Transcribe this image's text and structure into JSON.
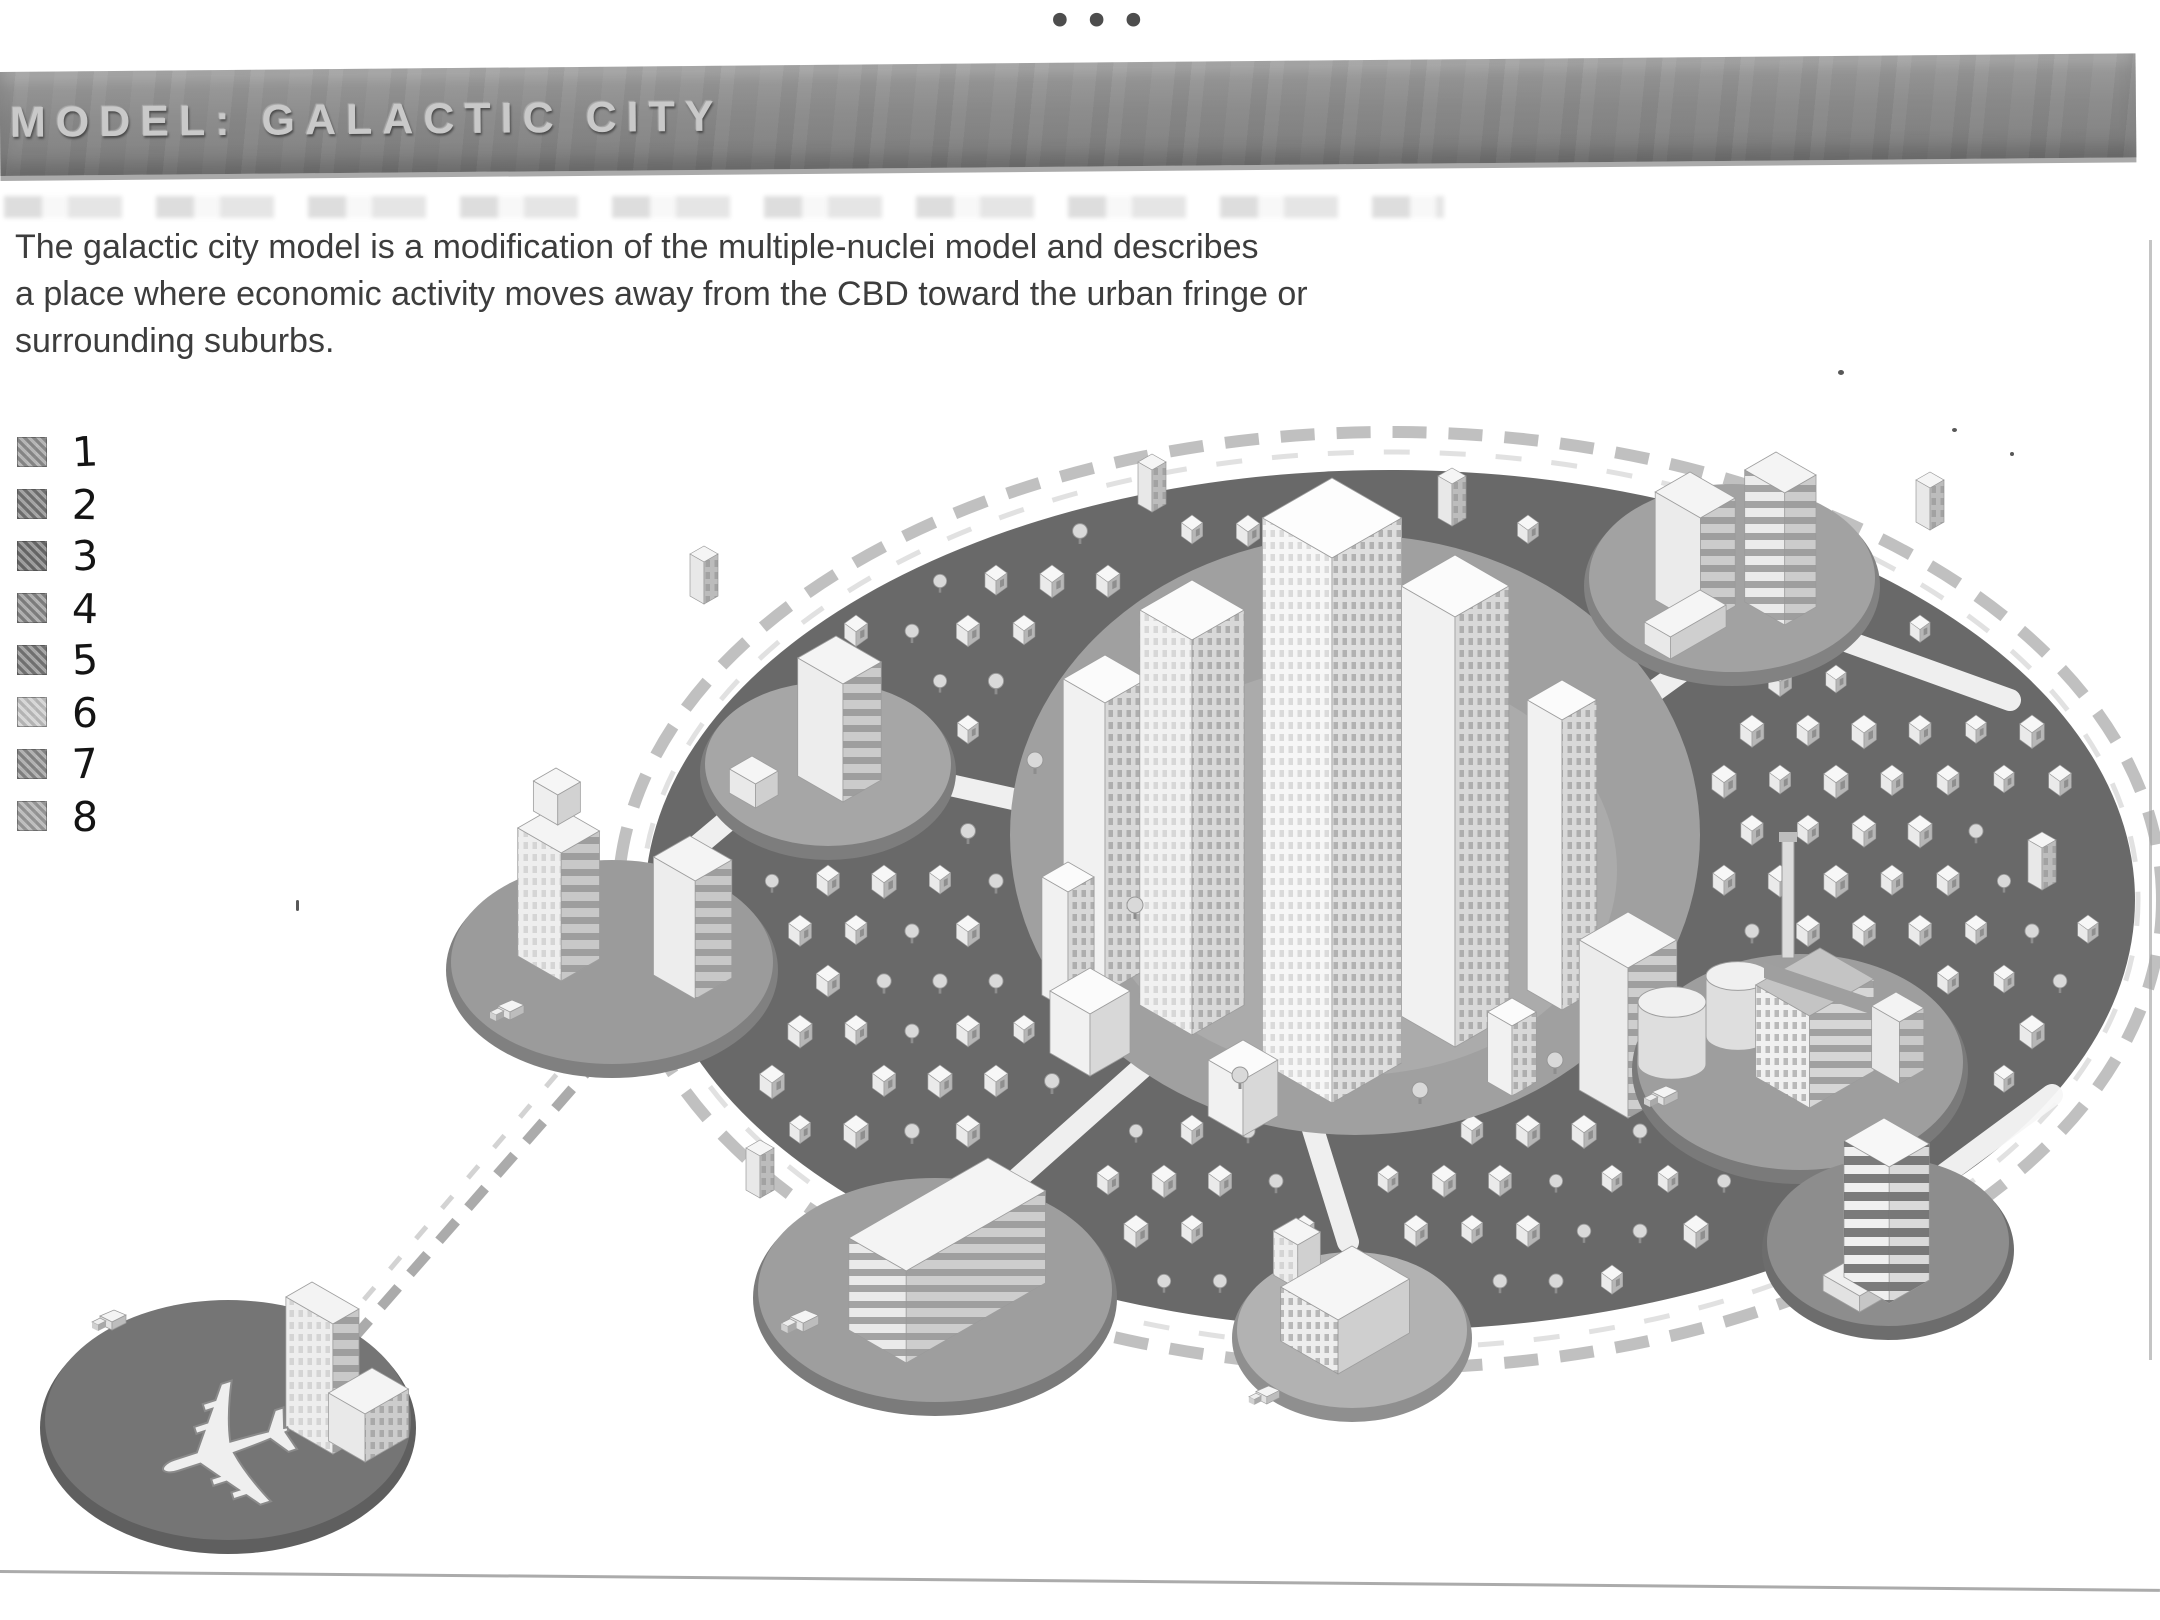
{
  "window": {
    "ellipsis_icon": "•••"
  },
  "header": {
    "title": "MODEL: GALACTIC CITY"
  },
  "intro": {
    "lines": [
      "The galactic city model is a modification of the multiple-nuclei model and describes",
      "a place where economic activity moves away from the CBD toward the urban fringe or",
      "surrounding suburbs."
    ]
  },
  "legend": {
    "items": [
      {
        "label": "1",
        "swatch": "#8f8f8f"
      },
      {
        "label": "2",
        "swatch": "#757575"
      },
      {
        "label": "3",
        "swatch": "#6b6b6b"
      },
      {
        "label": "4",
        "swatch": "#858585"
      },
      {
        "label": "5",
        "swatch": "#787878"
      },
      {
        "label": "6",
        "swatch": "#c2c2c2"
      },
      {
        "label": "7",
        "swatch": "#8a8a8a"
      },
      {
        "label": "8",
        "swatch": "#9d9d9d"
      }
    ]
  },
  "palette": {
    "suburb": "#696969",
    "cbd_ground": "#a0a0a0",
    "node_ground": "#a6a6a6",
    "node_rim": "#7d7d7d",
    "airport_ground": "#757575",
    "airport_rim": "#5f5f5f",
    "road": "#f7f7f7",
    "belt": "#b5b5b5",
    "belt_faint": "#d9d9d9",
    "house_top": "#f7f7f7",
    "house_left": "#eaeaea",
    "house_right": "#b6b6b6",
    "tree": "#d9d9d9",
    "bar": "#8b8b8b",
    "title_text": "#c9c9c9",
    "body_text": "#3d3d3d"
  }
}
